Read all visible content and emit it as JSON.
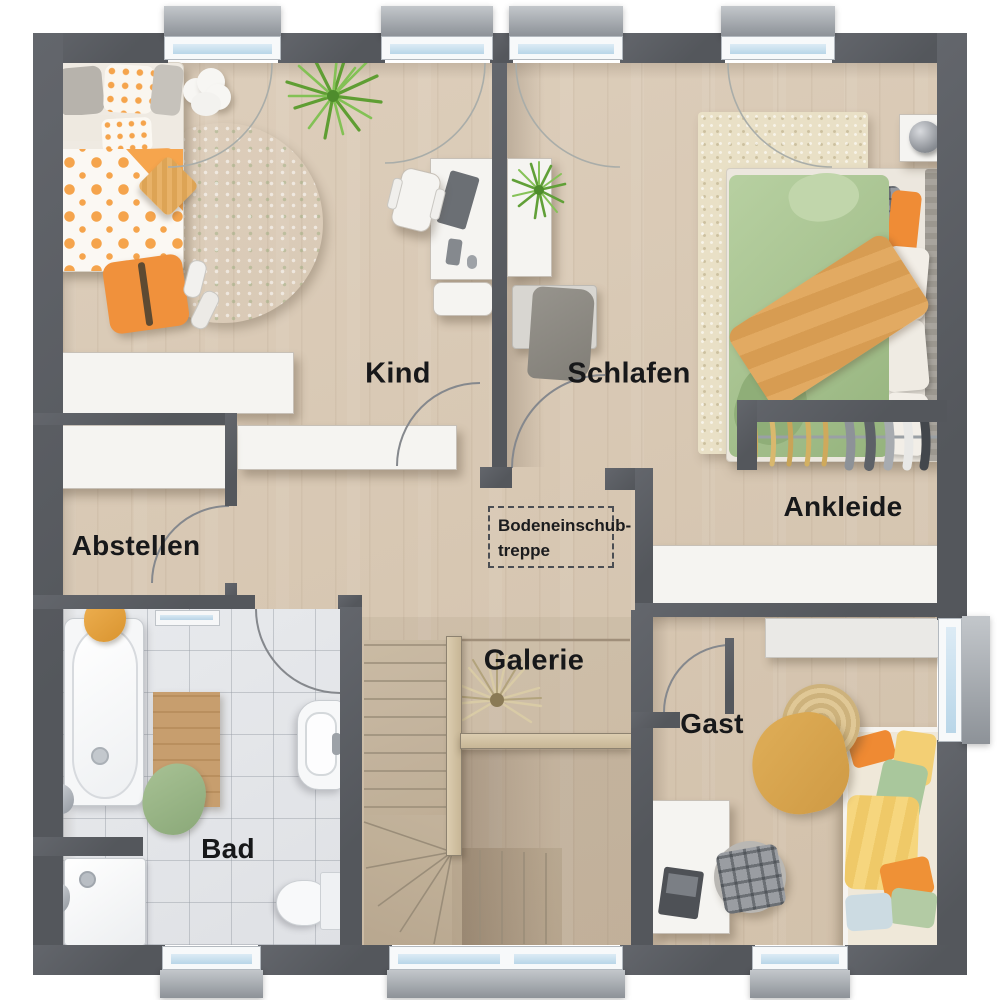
{
  "plan": {
    "rooms": [
      {
        "id": "kind",
        "label": "Kind"
      },
      {
        "id": "schlafen",
        "label": "Schlafen"
      },
      {
        "id": "abstellen",
        "label": "Abstellen"
      },
      {
        "id": "ankleide",
        "label": "Ankleide"
      },
      {
        "id": "bad",
        "label": "Bad"
      },
      {
        "id": "galerie",
        "label": "Galerie"
      },
      {
        "id": "gast",
        "label": "Gast"
      }
    ],
    "attic_hatch": {
      "line1": "Bodeneinschub-",
      "line2": "treppe"
    },
    "window_count": {
      "top": 4,
      "bottom": 3,
      "right": 1
    },
    "door_count": 5,
    "furniture_icons": [
      "single-bed-icon",
      "double-bed-icon",
      "guest-bed-icon",
      "desk-icon",
      "office-chair-icon",
      "round-rug-icon",
      "rug-icon",
      "bathtub-icon",
      "shower-icon",
      "toilet-icon",
      "washbasin-icon",
      "towel-radiator-icon",
      "wardrobe-rail-icon",
      "sideboard-icon",
      "stairs-icon",
      "plant-icon",
      "cloud-table-icon",
      "nightstand-lamp-icon",
      "pouf-icon",
      "laptop-icon"
    ],
    "colors": {
      "wall": "#55585d",
      "wood_floor": "#d7c7b2",
      "tile_floor": "#e4e6e9",
      "stair_wood": "#cdbda7",
      "accent_orange": "#f5a44c",
      "accent_green": "#a9c492",
      "rug_green": "#d2e2c0",
      "rug_beige": "#e9e0c6",
      "window_glass": "#c9e0ef",
      "furniture_white": "#f5f4f1",
      "label_text": "#17181a"
    }
  }
}
